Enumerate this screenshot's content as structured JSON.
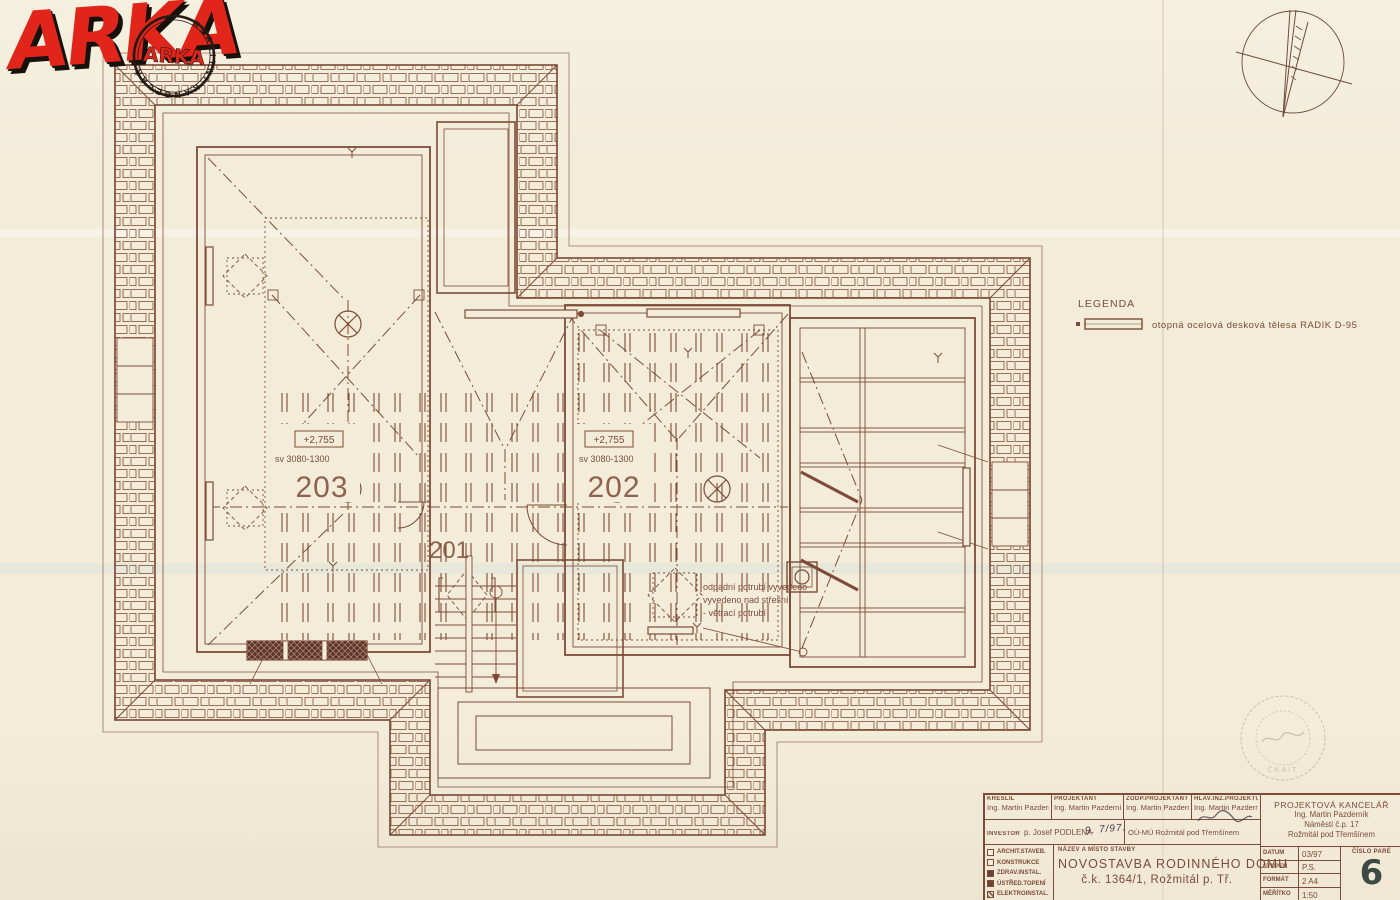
{
  "sheet": {
    "paper_color": "#f2ecd9",
    "ink_color": "#7d4b38"
  },
  "logo": {
    "text": "ARKA",
    "stamp_ring": "REALITNÍ KANCELÁŘ",
    "stamp_center": "ARKA",
    "red": "#e1251b"
  },
  "legend": {
    "title": "LEGENDA",
    "item": "otopná ocelová desková tělesa RADIK D-95"
  },
  "plan": {
    "rooms": [
      {
        "number": "203",
        "elevation": "+2,755",
        "clearance": "sv 3080-1300"
      },
      {
        "number": "202",
        "elevation": "+2,755",
        "clearance": "sv 3080-1300"
      },
      {
        "number": "201"
      }
    ],
    "annotation": [
      "odpadní potrubí vyvedeno",
      "vyvedeno nad střešní",
      "- větrací potrubí"
    ]
  },
  "authorization_stamp": {
    "text": "ČKAIT"
  },
  "title_block": {
    "roles": [
      {
        "label": "KRESLIL",
        "value": "Ing. Martin Pazderník"
      },
      {
        "label": "PROJEKTANT",
        "value": "Ing. Martin Pazderník"
      },
      {
        "label": "ZODP.PROJEKTANT",
        "value": "Ing. Martin Pazderník"
      },
      {
        "label": "HLAV.INŽ.PROJEKTU",
        "value": "Ing. Martin Pazderník"
      }
    ],
    "investor_label": "INVESTOR",
    "investor_value": "p. Josef PODLENA",
    "investor_handwriting": "9. 7/97.",
    "municipality": "OÚ-MÚ Rožmitál pod Třemšínem",
    "office_lines": [
      "PROJEKTOVÁ KANCELÁŘ",
      "Ing. Martin Pazderník",
      "Náměstí č.p. 17",
      "Rožmitál pod Třemšínem"
    ],
    "disciplines": [
      "ARCHIT.STAVEB.",
      "KONSTRUKCE",
      "ZDRAV.INSTAL.",
      "ÚSTŘED.TOPENÍ",
      "ELEKTROINSTAL."
    ],
    "name_label": "NÁZEV A MÍSTO STAVBY",
    "project_name": "NOVOSTAVBA RODINNÉHO DOMU",
    "project_detail": "č.k. 1364/1, Rožmitál p. Tř.",
    "meta": [
      {
        "label": "DATUM",
        "value": "03/97"
      },
      {
        "label": "STUPEŇ",
        "value": "P.S."
      },
      {
        "label": "FORMÁT",
        "value": "2 A4"
      },
      {
        "label": "MĚŘÍTKO",
        "value": "1:50"
      }
    ],
    "pare_label": "ČÍSLO PARÉ",
    "pare_number": "6"
  }
}
